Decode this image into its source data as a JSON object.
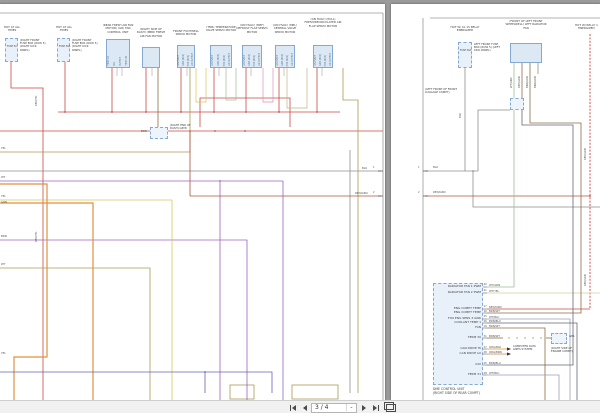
{
  "viewer": {
    "background_color": "#9b9b9b",
    "toolbar": {
      "page_indicator": "3 / 4",
      "scale_value": "-",
      "first_page_icon": "first-page",
      "previous_page_icon": "previous-page",
      "next_page_icon": "next-page",
      "last_page_icon": "last-page",
      "presentation_icon": "presentation-mode"
    }
  },
  "colors": {
    "wire_red": "#c74a42",
    "wire_red_green": "#b0523c",
    "wire_orange": "#e0913f",
    "wire_orange_brown": "#c98a3f",
    "wire_yellow": "#d8c95e",
    "wire_olive": "#a89a55",
    "wire_magenta": "#cc66cc",
    "wire_purple": "#9c63c3",
    "wire_blue": "#6463bd",
    "wire_gray": "#8f8f8f",
    "wire_brown": "#8d6e43",
    "wire_pale_green": "#9fbf9a",
    "wire_pale_yellow": "#d5cd9d",
    "wire_pale_blue": "#9aa0b8",
    "wire_brown_blue": "#666a78",
    "component_fill": "#dce9f5",
    "component_border": "#84a9d2"
  },
  "left_page": {
    "fuse_boxes": [
      {
        "hot": "HOT AT ALL TIMES",
        "fuse": "FUSE 5A",
        "location": "(RIGHT FRONT FUSE BOX (ROW 5) (RIGHT KICK PANEL)"
      },
      {
        "hot": "HOT AT ALL TIMES",
        "fuse": "FUSE 30A",
        "location": "(RIGHT FRONT FUSE BOX (ROW 5) (RIGHT KICK PANEL)"
      }
    ],
    "components": [
      {
        "label": "(REAR FRESH AIR FAN MOTOR) (GR) FAN CONTROL UNIT"
      },
      {
        "label": "(RIGHT SIDE OF DASH) (MBR) FRESH AIR FAN MOTOR"
      },
      {
        "label": "FRONT FOOTWELL SERVO MOTOR"
      },
      {
        "label": "(TMR) TEMPERATURE VALVE SERVO MOTOR"
      },
      {
        "label": "(ON HVAC) (MEF) DEFROST FLAP SERVO MOTOR"
      },
      {
        "label": "(ON HVAC) (MEL) CENTRAL VALVE SERVO MOTOR"
      },
      {
        "label": "(ON HVAC) (PULL) FRESH/RECIRCULATED AIR FLAP SERVO MOTOR"
      }
    ],
    "fan_control_pins": [
      "TERM 15",
      "SIG",
      "OUTPUT",
      "TERM 30"
    ],
    "servo_pins": [
      "LIN INPUT",
      "GND (BUS)",
      "POS (BUS)",
      "LIN OUTPUT"
    ],
    "connector": {
      "label": "(RIGHT END OF DASH) GRY8",
      "wire": "BRN"
    },
    "edge_pins": [
      {
        "num": "1",
        "wire": "BLK"
      },
      {
        "num": "2",
        "wire": "RED/GRN"
      }
    ],
    "red_yel_label": "RED/YEL",
    "left_edge_labels": [
      "YEL",
      "WT",
      "YEL",
      "GRN",
      "BRN",
      "WT",
      "YEL"
    ]
  },
  "right_page": {
    "fuse_box": {
      "hot": "HOT W/ KL 15 RELAY ENERGIZED",
      "fuse": "FUSE 30A",
      "location": "LEFT FRONT FUSE BOX (ROW 5) (LEFT KICK PANEL)",
      "wire": "BLK"
    },
    "radiator_fan": {
      "label": "(FRONT OF LEFT FRONT WHEELWELL) LEFT RADIATOR FAN",
      "pins": [
        "WT/GRN",
        "RED/GRN",
        "BRN/GRN",
        "BRN/GRN"
      ]
    },
    "relay_label": "HOT W/ RELAY 1 ENERGIZED",
    "relay_wire": "RED/GRN",
    "luggage_label": "(LEFT FRONT OF FRONT LUGGAGE COMPT)",
    "edge_pins": [
      {
        "num": "1",
        "wire": "BLK"
      },
      {
        "num": "2",
        "wire": "RED/GRN"
      }
    ],
    "dme": {
      "caption_line1": "DME CONTROL UNIT",
      "caption_line2": "(RIGHT SIDE OF REAR COMPT)",
      "rows": [
        {
          "fn": "RADIATOR FAN 1 PWM",
          "pin": "40",
          "wire": "WT/GRN"
        },
        {
          "fn": "RADIATOR FAN 2 PWM",
          "pin": "41",
          "wire": "WT/YEL"
        },
        {
          "fn": "ENG COMPT TEMP",
          "pin": "17",
          "wire": "RED/GRN"
        },
        {
          "fn": "ENG COMPT TEMP",
          "pin": "16",
          "wire": "BRN/WT"
        },
        {
          "fn": "FXO ENG SENS 3 GND",
          "pin": "25",
          "wire": "WT/BLU"
        },
        {
          "fn": "COOLANT TEMP 1",
          "pin": "26",
          "wire": "BRN/BLU"
        },
        {
          "fn": "FAN",
          "pin": "18",
          "wire": "BRN/WT"
        },
        {
          "fn": "TERM 30",
          "pin": "31",
          "wire": "BRN/WT"
        },
        {
          "fn": "CAN DRIVE HI",
          "pin": "27",
          "wire": "ORG/BLK"
        },
        {
          "fn": "CAN DRIVE LO",
          "pin": "28",
          "wire": "ORG/BRN"
        },
        {
          "fn": "24V",
          "pin": "45",
          "wire": "BRN/BLU"
        },
        {
          "fn": "TERM 31",
          "pin": "48",
          "wire": "WT/BLU"
        }
      ],
      "gps_label": "GPS",
      "gps_location": "(RIGHT SIDE OF ENGINE COMPT)",
      "can_note": "COMPUTER DATA LINES SYSTEM"
    }
  }
}
